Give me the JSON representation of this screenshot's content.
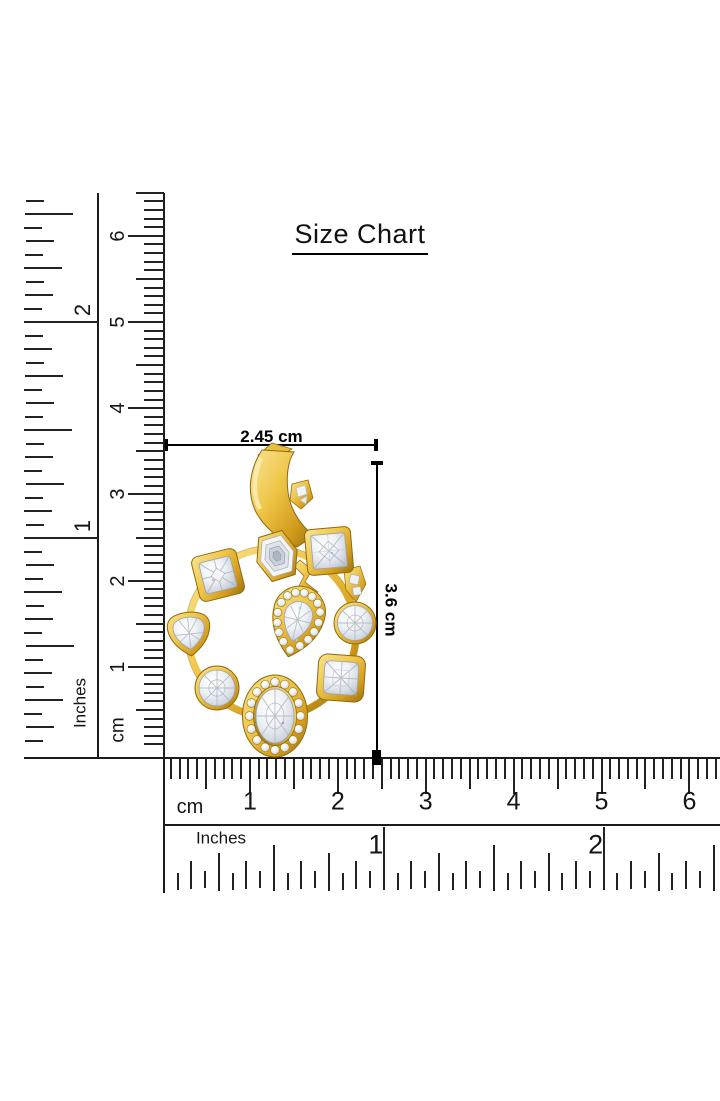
{
  "title": "Size Chart",
  "dimension_annotations": {
    "width": "2.45 cm",
    "height": "3.6 cm"
  },
  "rulers": {
    "vertical": {
      "inches": {
        "label": "Inches",
        "numbers": [
          "1",
          "2"
        ]
      },
      "cm": {
        "label": "cm",
        "numbers": [
          "1",
          "2",
          "3",
          "4",
          "5",
          "6"
        ]
      }
    },
    "horizontal": {
      "cm": {
        "label": "cm",
        "numbers": [
          "1",
          "2",
          "3",
          "4",
          "5",
          "6"
        ]
      },
      "inches": {
        "label": "Inches",
        "numbers": [
          "1",
          "2"
        ]
      }
    }
  },
  "product": {
    "name": "gold-diamond-multi-shape-circle-pendant",
    "colors": {
      "gold": "#D9A427",
      "gold_dark": "#8F6A0D",
      "diamond": "#E9EDF2",
      "line": "#000000"
    }
  }
}
